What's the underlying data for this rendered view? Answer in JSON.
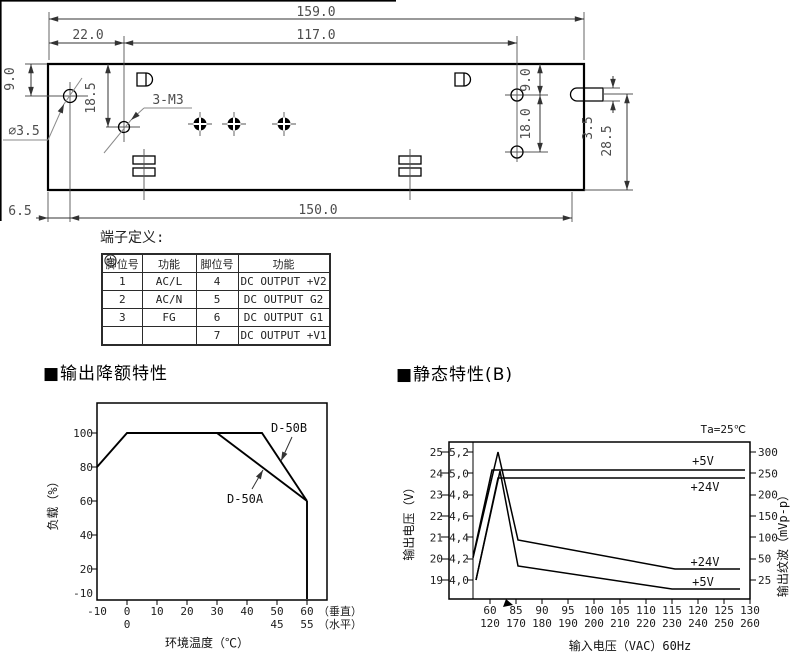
{
  "drawing": {
    "labels": {
      "total_width": "159.0",
      "left_to_m3": "22.0",
      "m3_to_right_hole": "117.0",
      "left_hole_from_top": "9.0",
      "m3_from_top": "18.5",
      "hole_diameter": "∅3.5",
      "m3_callout": "3-M3",
      "right_hole_from_top": "9.0",
      "right_holes_gap": "18.0",
      "tab_thickness": "3.5",
      "tab_to_bottom": "28.5",
      "edge_to_hole": "6.5",
      "hole_span": "150.0"
    }
  },
  "terminal_table": {
    "title": "端子定义:",
    "headers": [
      "脚位号",
      "功能",
      "脚位号",
      "功能"
    ],
    "rows": [
      [
        "1",
        "AC/L",
        "4",
        "DC OUTPUT +V2"
      ],
      [
        "2",
        "AC/N",
        "5",
        "DC OUTPUT G2"
      ],
      [
        "3",
        "FG",
        "6",
        "DC OUTPUT G1"
      ],
      [
        "",
        "",
        "7",
        "DC OUTPUT +V1"
      ]
    ]
  },
  "sections": {
    "derating": "■输出降额特性",
    "static": "■静态特性(B)"
  },
  "chart_data": [
    {
      "type": "line",
      "title": "输出降额特性",
      "xlabel": "环境温度（℃）",
      "ylabel": "负载（%）",
      "grid": false,
      "y_ticks": [
        "100",
        "80",
        "60",
        "40",
        "20"
      ],
      "y_bottom_label": "-10",
      "x_ticks": [
        "-10",
        "0",
        "10",
        "20",
        "30",
        "40",
        "50",
        "60"
      ],
      "x_ticks_row2": {
        "under_0": "0",
        "under_50": "45",
        "under_60": "55"
      },
      "x_row1_suffix": "（垂直）",
      "x_row2_suffix": "（水平）",
      "xlim": [
        -10,
        60
      ],
      "ylim": [
        0,
        110
      ],
      "series": [
        {
          "name": "D-50B",
          "points": [
            [
              -10,
              80
            ],
            [
              0,
              100
            ],
            [
              45,
              100
            ],
            [
              60,
              60
            ],
            [
              60,
              0
            ]
          ]
        },
        {
          "name": "D-50A",
          "points": [
            [
              30,
              100
            ],
            [
              60,
              60
            ]
          ]
        }
      ]
    },
    {
      "type": "line",
      "title": "静态特性(B)",
      "note": "Ta=25℃",
      "xlabel": "输入电压（VAC）60Hz",
      "ylabel_left": "输出电压（V）",
      "ylabel_right": "输出纹波（mVp-p）",
      "grid": false,
      "y_ticks_voltage24": [
        "25",
        "24",
        "23",
        "22",
        "21",
        "20",
        "19"
      ],
      "y_ticks_voltage5": [
        "5,2",
        "5,0",
        "4,8",
        "4,6",
        "4,4",
        "4,2",
        "4,0"
      ],
      "y_ticks_ripple": [
        "300",
        "250",
        "200",
        "150",
        "100",
        "50",
        "25"
      ],
      "x_ticks_60hz": [
        "60",
        "85",
        "90",
        "95",
        "100",
        "105",
        "110",
        "115",
        "120",
        "125",
        "130"
      ],
      "x_ticks_row2": [
        "120",
        "170",
        "180",
        "190",
        "200",
        "210",
        "220",
        "230",
        "240",
        "250",
        "260"
      ],
      "series": [
        {
          "name": "+5V",
          "role": "output-voltage",
          "unit": "V",
          "points": [
            [
              60,
              5.0
            ],
            [
              130,
              5.0
            ]
          ]
        },
        {
          "name": "+24V",
          "role": "output-voltage",
          "unit": "V",
          "points": [
            [
              60,
              23.9
            ],
            [
              130,
              23.9
            ]
          ]
        },
        {
          "name": "+24V",
          "role": "output-ripple",
          "unit": "mVp-p",
          "points": [
            [
              60,
              300
            ],
            [
              85,
              100
            ],
            [
              115,
              40
            ],
            [
              130,
              40
            ]
          ]
        },
        {
          "name": "+5V",
          "role": "output-ripple",
          "unit": "mVp-p",
          "points": [
            [
              60,
              250
            ],
            [
              85,
              45
            ],
            [
              115,
              20
            ],
            [
              130,
              20
            ]
          ]
        }
      ]
    }
  ]
}
